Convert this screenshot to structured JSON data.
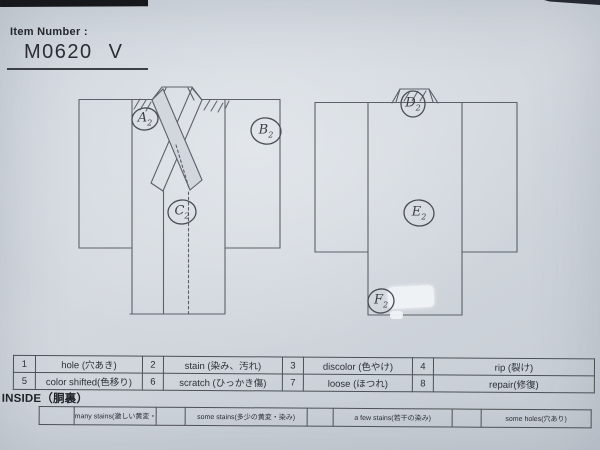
{
  "header": {
    "item_label": "Item Number :",
    "item_number": "M0620",
    "item_suffix": "V"
  },
  "labels": {
    "front": [
      {
        "letter": "A",
        "sub": "2"
      },
      {
        "letter": "B",
        "sub": "2"
      },
      {
        "letter": "C",
        "sub": "2"
      }
    ],
    "back": [
      {
        "letter": "D",
        "sub": "2"
      },
      {
        "letter": "E",
        "sub": "2"
      },
      {
        "letter": "F",
        "sub": "2"
      }
    ]
  },
  "legend": {
    "items": [
      {
        "num": "1",
        "label": "hole (穴あき)"
      },
      {
        "num": "2",
        "label": "stain (染み、汚れ)"
      },
      {
        "num": "3",
        "label": "discolor (色やけ)"
      },
      {
        "num": "4",
        "label": "rip (裂け)"
      },
      {
        "num": "5",
        "label": "color shifted(色移り)"
      },
      {
        "num": "6",
        "label": "scratch (ひっかき傷)"
      },
      {
        "num": "7",
        "label": "loose (ほつれ)"
      },
      {
        "num": "8",
        "label": "repair(修復)"
      }
    ]
  },
  "inside": {
    "title": "INSIDE（胴裏）",
    "options": [
      {
        "label": "many stains(激しい黄変・染み)"
      },
      {
        "label": "some stains(多少の黄変・染み)"
      },
      {
        "label": "a few stains(若干の染み)"
      },
      {
        "label": "some holes(穴あり)"
      }
    ]
  },
  "colors": {
    "paper": "#d2d7dd",
    "diagram_line": "#5d6068",
    "pencil": "#4a4d54",
    "ink": "#2d3036",
    "photo_edge": "#16181b"
  }
}
